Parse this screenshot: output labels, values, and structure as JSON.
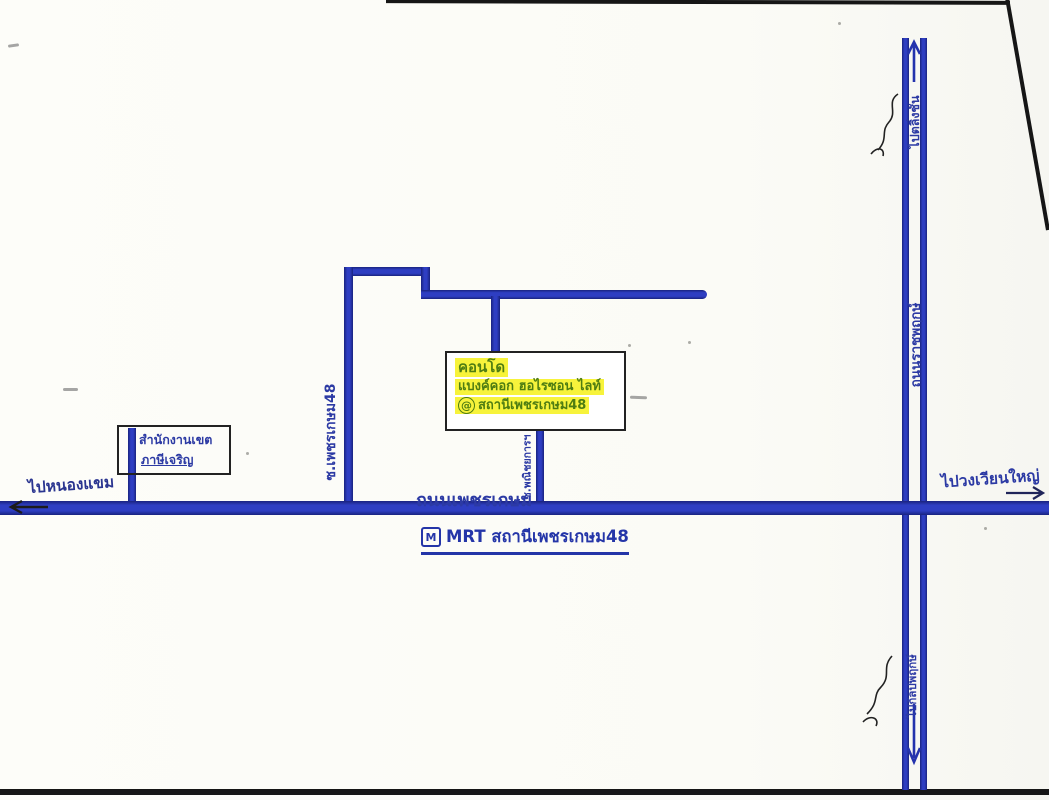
{
  "condo": {
    "name_line1": "คอนโด",
    "name_line2": "แบงค์คอก ฮอไรซอน ไลท์",
    "at_symbol": "@",
    "station_line": "สถานีเพชรเกษม48"
  },
  "district_office": {
    "line1": "สำนักงานเขต",
    "line2": "ภาษีเจริญ"
  },
  "roads": {
    "phetkasem": "ถนนเพชรเกษม",
    "soi_48": "ซ.เพชรเกษม48",
    "soi_commercial": "ซ.พณิชยการฯ",
    "ratchaphruek": "ถนนราชพฤกษ์"
  },
  "directions": {
    "west": "ไปหนองแขม",
    "east": "ไปวงเวียนใหญ่",
    "north": "ไปตลิ่งชัน",
    "south": "ไปกัลปพฤกษ์"
  },
  "mrt": {
    "logo_letter": "M",
    "station_label": "MRT สถานีเพชรเกษม48"
  },
  "colors": {
    "road_blue": "#2433ad",
    "ink_blue": "#2c3aa4",
    "highlight_yellow": "#f7f33b",
    "ink_green": "#4f7d12",
    "border_black": "#1c1c1c"
  }
}
